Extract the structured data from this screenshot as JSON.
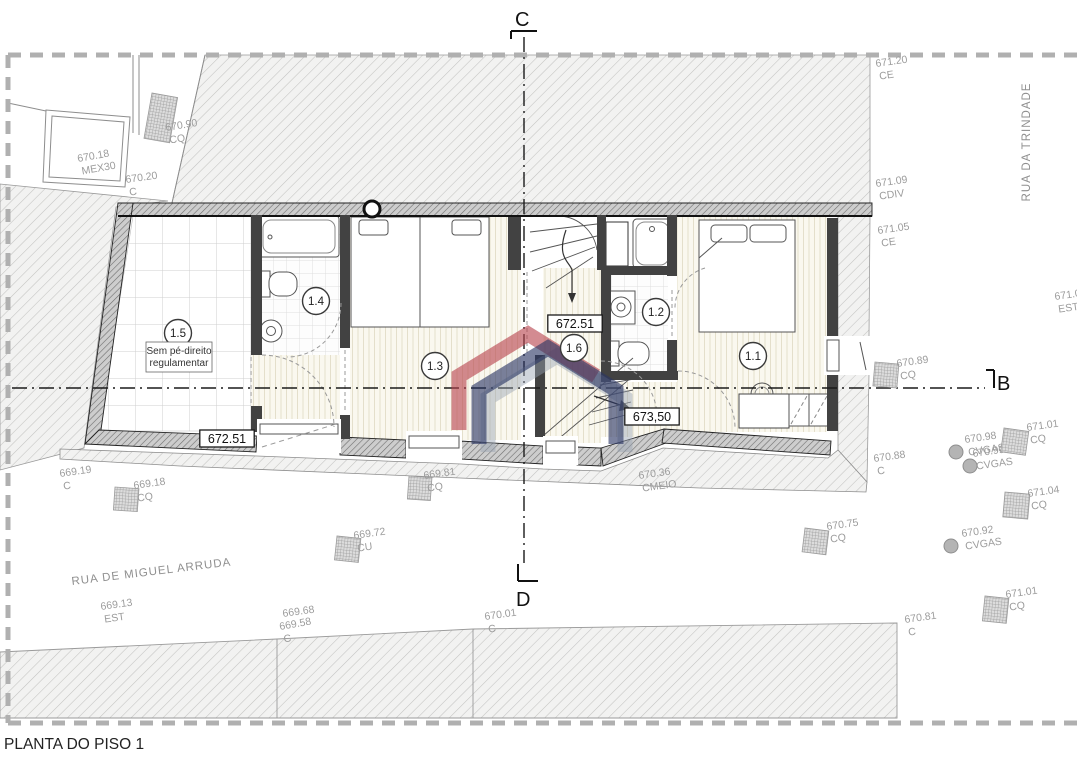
{
  "title": "PLANTA DO PISO 1",
  "streets": {
    "trindade": "RUA DA TRINDADE",
    "miguel_arruda": "RUA DE MIGUEL ARRUDA"
  },
  "sections": {
    "top": "C",
    "bottom": "D",
    "right": "B"
  },
  "note": {
    "line1": "Sem pé-direito",
    "line2": "regulamentar"
  },
  "rooms": [
    {
      "label": "1.5",
      "x": 178,
      "y": 333
    },
    {
      "label": "1.4",
      "x": 316,
      "y": 301
    },
    {
      "label": "1.3",
      "x": 435,
      "y": 366
    },
    {
      "label": "1.6",
      "x": 574,
      "y": 348
    },
    {
      "label": "1.2",
      "x": 656,
      "y": 312
    },
    {
      "label": "1.1",
      "x": 753,
      "y": 356
    }
  ],
  "levels": [
    {
      "value": "672.51",
      "x": 227,
      "y": 439
    },
    {
      "value": "672.51",
      "x": 575,
      "y": 324
    },
    {
      "value": "673,50",
      "x": 652,
      "y": 417
    }
  ],
  "survey_points": [
    {
      "value": "670.90",
      "code": "CQ",
      "x": 166,
      "y": 131,
      "rot": -9,
      "marker": "square",
      "mx": 152,
      "my": 93,
      "mw": 26,
      "mh": 46,
      "mrot": 10
    },
    {
      "value": "670.18",
      "code": "MEX30",
      "x": 78,
      "y": 162,
      "rot": -10
    },
    {
      "value": "670.20",
      "code": "C",
      "x": 126,
      "y": 183,
      "rot": -8
    },
    {
      "value": "671.20",
      "code": "CE",
      "x": 876,
      "y": 67,
      "rot": -8
    },
    {
      "value": "671.09",
      "code": "CDIV",
      "x": 876,
      "y": 187,
      "rot": -8
    },
    {
      "value": "671.05",
      "code": "CE",
      "x": 878,
      "y": 234,
      "rot": -8
    },
    {
      "value": "671.0",
      "code": "EST",
      "x": 1055,
      "y": 300,
      "rot": -8
    },
    {
      "value": "670.89",
      "code": "CQ",
      "x": 897,
      "y": 367,
      "rot": -8,
      "marker": "square",
      "mx": 875,
      "my": 362,
      "mw": 24,
      "mh": 24,
      "mrot": 5
    },
    {
      "value": "670.88",
      "code": "C",
      "x": 874,
      "y": 462,
      "rot": -8
    },
    {
      "value": "670.98",
      "code": "CVGAS",
      "x": 965,
      "y": 443,
      "rot": -8,
      "marker": "circle",
      "mx": 956,
      "my": 452
    },
    {
      "value": "670.99",
      "code": "CVGAS",
      "x": 973,
      "y": 457,
      "rot": -8,
      "marker": "circle",
      "mx": 970,
      "my": 466
    },
    {
      "value": "671.01",
      "code": "CQ",
      "x": 1027,
      "y": 431,
      "rot": -8,
      "marker": "square",
      "mx": 1004,
      "my": 428,
      "mw": 25,
      "mh": 24,
      "mrot": 8
    },
    {
      "value": "671.04",
      "code": "CQ",
      "x": 1028,
      "y": 497,
      "rot": -8,
      "marker": "square",
      "mx": 1005,
      "my": 492,
      "mw": 25,
      "mh": 25,
      "mrot": 5
    },
    {
      "value": "670.75",
      "code": "CQ",
      "x": 827,
      "y": 530,
      "rot": -8,
      "marker": "square",
      "mx": 805,
      "my": 528,
      "mw": 24,
      "mh": 24,
      "mrot": 7
    },
    {
      "value": "670.92",
      "code": "CVGAS",
      "x": 962,
      "y": 537,
      "rot": -8,
      "marker": "circle",
      "mx": 951,
      "my": 546
    },
    {
      "value": "671.01",
      "code": "CQ",
      "x": 1006,
      "y": 598,
      "rot": -8,
      "marker": "square",
      "mx": 985,
      "my": 596,
      "mw": 24,
      "mh": 25,
      "mrot": 6
    },
    {
      "value": "670.81",
      "code": "C",
      "x": 905,
      "y": 623,
      "rot": -8
    },
    {
      "value": "669.19",
      "code": "C",
      "x": 60,
      "y": 477,
      "rot": -8
    },
    {
      "value": "669.18",
      "code": "CQ",
      "x": 134,
      "y": 489,
      "rot": -8,
      "marker": "square",
      "mx": 115,
      "my": 487,
      "mw": 24,
      "mh": 23,
      "mrot": 4
    },
    {
      "value": "669.81",
      "code": "CQ",
      "x": 424,
      "y": 479,
      "rot": -8,
      "marker": "square",
      "mx": 409,
      "my": 476,
      "mw": 23,
      "mh": 23,
      "mrot": 4
    },
    {
      "value": "669.72",
      "code": "CU",
      "x": 354,
      "y": 539,
      "rot": -8,
      "marker": "square",
      "mx": 337,
      "my": 536,
      "mw": 24,
      "mh": 24,
      "mrot": 6
    },
    {
      "value": "670.36",
      "code": "CMEIO",
      "x": 639,
      "y": 479,
      "rot": -8
    },
    {
      "value": "669.13",
      "code": "EST",
      "x": 101,
      "y": 610,
      "rot": -8
    },
    {
      "value": "669.68",
      "code": "",
      "x": 283,
      "y": 617,
      "rot": -8
    },
    {
      "value": "669.58",
      "code": "C",
      "x": 280,
      "y": 630,
      "rot": -10
    },
    {
      "value": "670.01",
      "code": "C",
      "x": 485,
      "y": 620,
      "rot": -8
    }
  ],
  "colors": {
    "logo_red": "#b8444d",
    "logo_navy": "#2a3564",
    "logo_gray": "#97a2b2",
    "boundary_dash": "#b0b0b0",
    "survey_text": "#9c9c9c"
  }
}
